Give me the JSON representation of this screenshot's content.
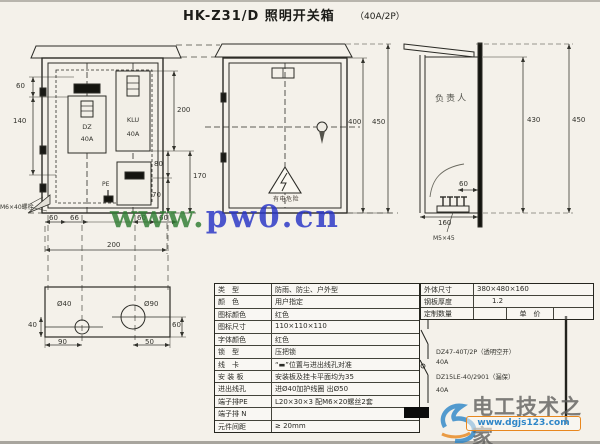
{
  "title": {
    "main": "HK-Z31/D 照明开关箱",
    "rating": "（40A/2P）"
  },
  "open_view": {
    "device1_name": "DZ",
    "device1_rating": "40A",
    "device2_name": "KLU",
    "device2_rating": "40A",
    "pe_label": "PE",
    "bolt_note": "M6×40螺栓",
    "dim_60_left": "60",
    "dim_140": "140",
    "dim_200_right": "200",
    "dim_80": "80",
    "dim_170": "170",
    "dim_70": "70",
    "dim_b1": "60",
    "dim_b2": "66",
    "dim_b3": "60",
    "dim_b4": "60",
    "dim_total": "200"
  },
  "front_view": {
    "warning": "有电危险",
    "dim_400": "400",
    "dim_450": "450"
  },
  "side_view": {
    "owner": "负责人",
    "dim_430": "430",
    "dim_450": "450",
    "dim_160": "160",
    "dim_60": "60",
    "bolt_note": "M5×45"
  },
  "plan_view": {
    "hole_small": "Ø40",
    "hole_large": "Ø90",
    "dim_40": "40",
    "dim_90": "90",
    "dim_50": "50",
    "dim_60": "60"
  },
  "spec_table": {
    "rows": [
      {
        "label": "类　型",
        "value": "防雨、防尘、户外型"
      },
      {
        "label": "颜　色",
        "value": "用户指定"
      },
      {
        "label": "图标颜色",
        "value": "红色"
      },
      {
        "label": "图标尺寸",
        "value": "110×110×110"
      },
      {
        "label": "字体颜色",
        "value": "红色"
      },
      {
        "label": "锁　型",
        "value": "压把锁"
      },
      {
        "label": "线　卡",
        "value": "“▬”位置与进出线孔对准"
      },
      {
        "label": "安 装 板",
        "value": "安装板及挂卡平面均为35"
      },
      {
        "label": "进出线孔",
        "value": "进Ø40加护线圈 出Ø50"
      },
      {
        "label": "端子排PE",
        "value": "L20×30×3 配M6×20螺丝2套"
      },
      {
        "label": "端子排 N",
        "value": ""
      },
      {
        "label": "元件间距",
        "value": "≥ 20mm"
      }
    ]
  },
  "info_table": {
    "rows": [
      {
        "label": "外体尺寸",
        "value": "380×480×160"
      },
      {
        "label": "钢板厚度",
        "value": "1.2"
      }
    ],
    "row3": {
      "label": "定制数量",
      "qty": "",
      "price_label": "单　价",
      "price": ""
    }
  },
  "circuit": {
    "breaker1": "DZ47-40T/2P（透明空开）",
    "breaker1_rating": "40A",
    "breaker2": "DZ15LE-40/2901（漏保）",
    "breaker2_rating": "40A"
  },
  "watermarks": {
    "site1_prefix": "www.",
    "site1_domain": "pw0.cn",
    "site2_name": "电工技术之家",
    "site2_url": "www.dgjs123.com"
  },
  "colors": {
    "watermark_green": "#2f7d32",
    "watermark_blue": "#2633c6",
    "accent_orange": "#e8871e",
    "logo_blue": "#2e86c8"
  }
}
